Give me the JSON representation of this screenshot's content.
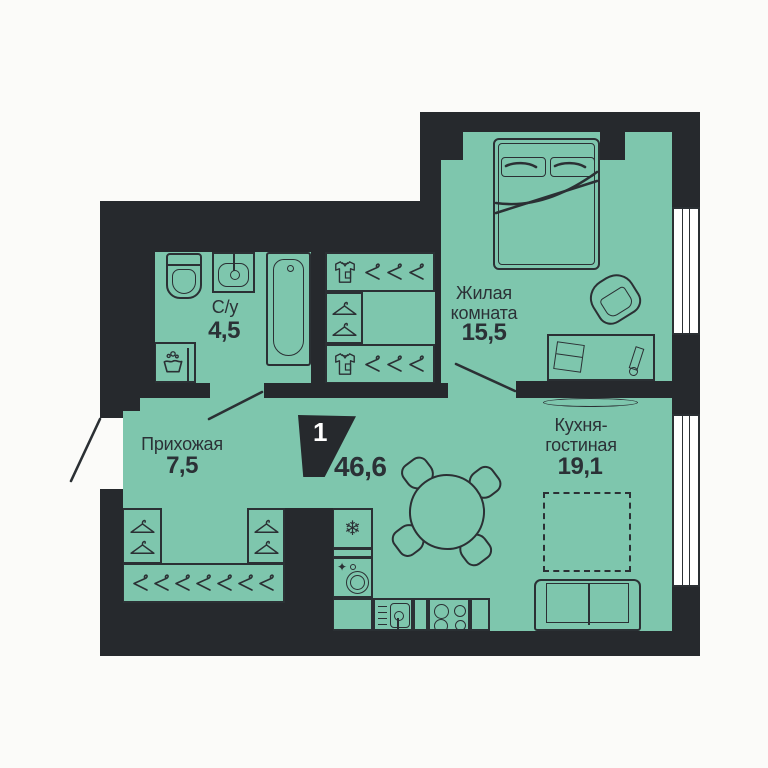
{
  "plan": {
    "badge": {
      "rooms_count": "1",
      "total_area": "46,6"
    },
    "rooms": [
      {
        "name": "С/у",
        "area": "4,5"
      },
      {
        "name": "Жилая комната",
        "area": "15,5",
        "lines": [
          "Жилая",
          "комната"
        ]
      },
      {
        "name": "Прихожая",
        "area": "7,5"
      },
      {
        "name": "Кухня-гостиная",
        "area": "19,1",
        "lines": [
          "Кухня-",
          "гостиная"
        ]
      }
    ],
    "icons": {
      "snowflake": "❄",
      "sparkle": "✦"
    },
    "colors": {
      "wall": "#26292d",
      "floor": "#7ec6ad",
      "line": "#2b3034",
      "text": "#2b3136",
      "bg": "#fbfbf9",
      "badge_text": "#ffffff"
    }
  }
}
